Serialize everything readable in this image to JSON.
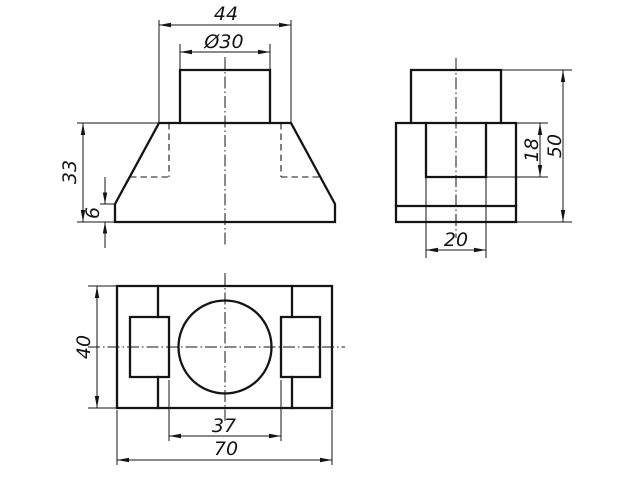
{
  "drawing": {
    "type": "orthographic-engineering-drawing",
    "background": "#ffffff",
    "line_color": "#141414",
    "views": {
      "front": {
        "title": "front-view",
        "labels": {
          "top_width": "44",
          "boss_diameter": "Ø30",
          "body_height": "33",
          "base_height": "6"
        }
      },
      "side": {
        "title": "side-view",
        "labels": {
          "slot_depth": "18",
          "total_height": "50",
          "slot_width": "20"
        }
      },
      "top": {
        "title": "top-view",
        "labels": {
          "depth": "40",
          "slot_span": "37",
          "overall_width": "70"
        }
      }
    }
  }
}
